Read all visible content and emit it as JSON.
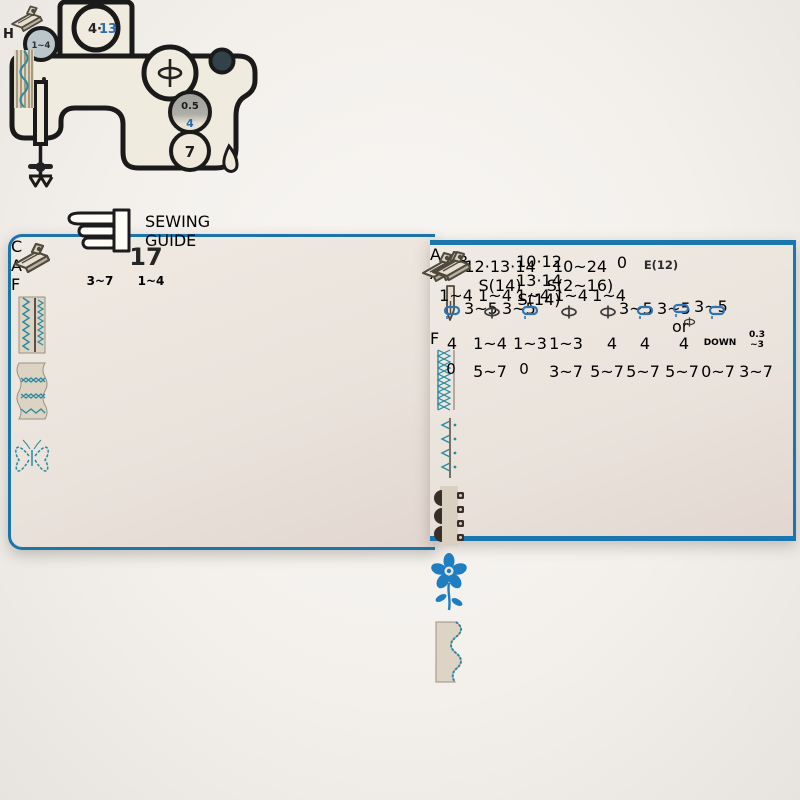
{
  "meta": {
    "description": "Sewing guide slide chart photograph"
  },
  "colors": {
    "panel_teal": "#7dcfd8",
    "accent_blue": "#2e6fae",
    "stitch_teal": "#2a8aa0",
    "border_blue": "#1a76ae"
  },
  "left_card": {
    "pattern_number": "17",
    "tension": "3~7",
    "stitch_length": "1~4",
    "feet": {
      "c": "C",
      "a": "A",
      "f": "F"
    }
  },
  "slider": {
    "title": {
      "line1": "SEWING",
      "line2": "GUIDE"
    },
    "top_dial": {
      "black": "4·",
      "blue": "13"
    },
    "needle_dial": "1~4",
    "mid_dial": {
      "black": "0.5",
      "blue": "4"
    },
    "bottom_dial": "7",
    "foot_letter": "H"
  },
  "right_card": {
    "pattern_row": [
      "8",
      "12·13·14\nS(14)",
      "10·12\n13·14\nS(14)",
      "10~24\nS(2~16)",
      "0",
      "E(12)"
    ],
    "tension_row": [
      "1~4",
      "1~4",
      "1~4",
      "1~4",
      "1~4"
    ],
    "foot_row": {
      "sups": [
        "3~5",
        "3~5",
        "",
        "",
        "3~5",
        "3~5",
        "3~5",
        ""
      ],
      "or_label": "or"
    },
    "width_row": [
      "4",
      {
        "black": "1~",
        "blue": "4"
      },
      "1~3",
      "1~3",
      "4",
      "4",
      "4",
      "DOWN",
      "0.3\n~3"
    ],
    "length_row": [
      "0",
      "5~7",
      "0",
      "3~7",
      "5~7",
      "5~7",
      "5~7",
      "0~7",
      "3~7"
    ],
    "feet_letters": {
      "a1": "A",
      "a2": "A",
      "f": "F"
    }
  }
}
